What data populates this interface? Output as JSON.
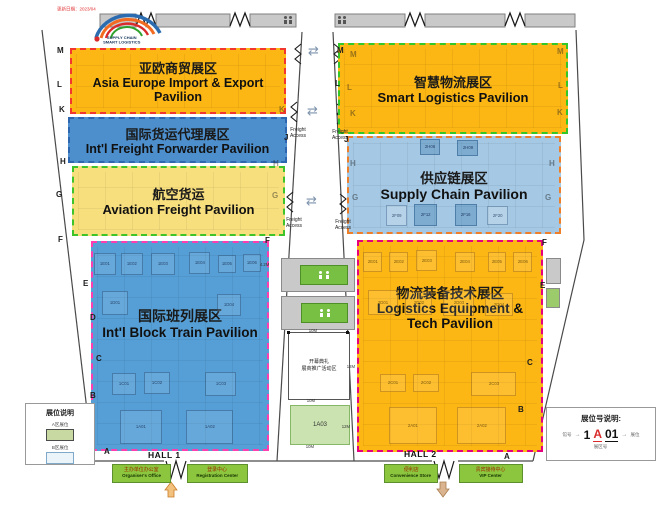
{
  "note": {
    "text": "更新日期：2023/04"
  },
  "logo": {
    "line1": "SUPPLY CHAIN",
    "line2": "SMART LOGISTICS"
  },
  "pavilions": [
    {
      "zh": "亚欧商贸展区",
      "en": "Asia Europe  Import & Export Pavilion"
    },
    {
      "zh": "国际货运代理展区",
      "en": "Int'l Freight  Forwarder Pavilion"
    },
    {
      "zh": "航空货运",
      "en": "Aviation Freight Pavilion"
    },
    {
      "zh": "国际班列展区",
      "en": "Int'l Block Train Pavilion"
    },
    {
      "zh": "智慧物流展区",
      "en": "Smart Logistics Pavilion"
    },
    {
      "zh": "供应链展区",
      "en": "Supply Chain Pavilion"
    },
    {
      "zh": "物流装备技术展区",
      "en": "Logistics Equipment & Tech Pavilion"
    }
  ],
  "corridor": {
    "freight_access": "Freight Access",
    "arrow_icon": "⇄"
  },
  "center": {
    "event_line1": "开幕典礼",
    "event_line2": "展商推广活动区",
    "green_booth": "1A03"
  },
  "halls": {
    "hall1": "HALL 1",
    "hall2": "HALL 2"
  },
  "facilities": [
    {
      "zh": "主办单位办公室",
      "en": "Organiser's Office"
    },
    {
      "zh": "登录中心",
      "en": "Registration Center"
    },
    {
      "zh": "便利店",
      "en": "Convenience Store"
    },
    {
      "zh": "贵宾接待中心",
      "en": "VIP Center"
    }
  ],
  "legend_left": {
    "title": "展位说明",
    "item1": "A区展位",
    "item2": "B区展位"
  },
  "legend_right": {
    "title": "展位号说明:",
    "hall_digit": "1",
    "zone_letter": "A",
    "booth_digits": "01",
    "label_left": "馆号",
    "label_right": "展位",
    "label_bottom": "展区号"
  },
  "row_letters": [
    "M",
    "L",
    "K",
    "H",
    "G",
    "F",
    "E",
    "D",
    "C",
    "B",
    "A",
    "K",
    "H",
    "G",
    "F",
    "J",
    "J",
    "M",
    "L",
    "M",
    "L",
    "K",
    "H",
    "G",
    "M",
    "L",
    "K",
    "H",
    "G",
    "F",
    "E",
    "C",
    "B",
    "A"
  ],
  "booth_labels": [
    "1E01",
    "1E02",
    "1E03",
    "1E04",
    "1E05",
    "1E06",
    "1D01",
    "1D04",
    "1C01",
    "1C02",
    "1C03",
    "1A01",
    "1A02",
    "2H06",
    "2H09",
    "2F09",
    "2F12",
    "2F16",
    "2F20",
    "2E01",
    "2E02",
    "2E03",
    "2E04",
    "2E05",
    "2E06",
    "2D01",
    "2D02",
    "2D03",
    "2D04",
    "2C01",
    "2C02",
    "2C03",
    "2A01",
    "2A02"
  ],
  "dim_labels": [
    "4.2M",
    "10M",
    "12M",
    "10M",
    "12M",
    "10M"
  ],
  "colors": {
    "orange": "#FDB714",
    "blue": "#4D8FCC",
    "light_blue": "#A5C8E4",
    "mid_blue": "#569FD6",
    "pale_yellow": "#F8DF7E",
    "facility_green": "#8CC63F",
    "border_red": "#F2372E",
    "border_green": "#35C727",
    "border_blue": "#2E66B0",
    "border_orange": "#EE7E28",
    "border_magenta": "#FF3DAE",
    "border_pink": "#E6007E"
  }
}
